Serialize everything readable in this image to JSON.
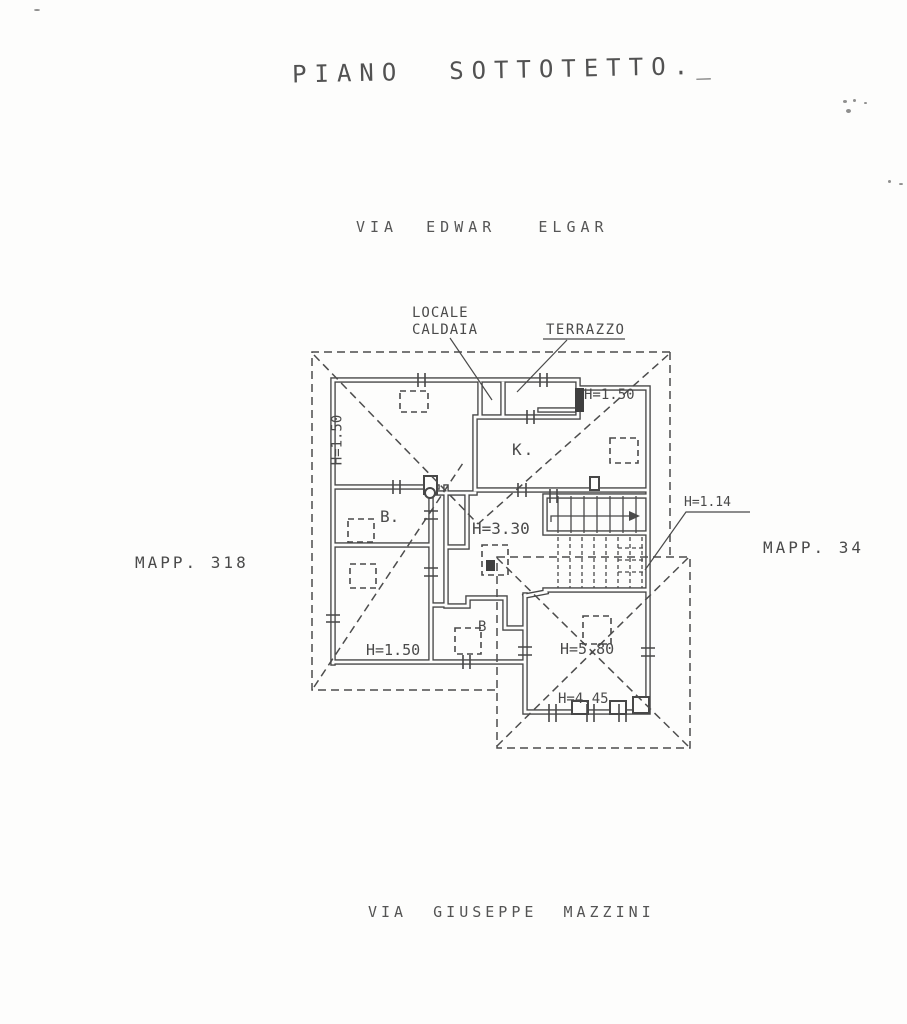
{
  "title": "PIANO  SOTTOTETTO._",
  "streets": {
    "top": "VIA  EDWAR   ELGAR",
    "bottom": "VIA  GIUSEPPE  MAZZINI"
  },
  "parcels": {
    "left": "MAPP. 318",
    "right": "MAPP. 34"
  },
  "callouts": {
    "boiler_room": "LOCALE\nCALDAIA",
    "terrace": "TERRAZZO"
  },
  "rooms": {
    "kitchen": "K.",
    "bath_main": "B.",
    "bath_small": "B"
  },
  "heights": {
    "left_room": "H=1.50",
    "top_right_room": "H=1.50",
    "hall": "H=3.30",
    "bottom_left_room": "H=1.50",
    "under_stair": "H=1.14",
    "wing_ridge": "H=5.80",
    "wing_eaves": "H=4.45"
  },
  "colors": {
    "ink": "#4a4a4a",
    "paper": "#fdfdfc"
  }
}
